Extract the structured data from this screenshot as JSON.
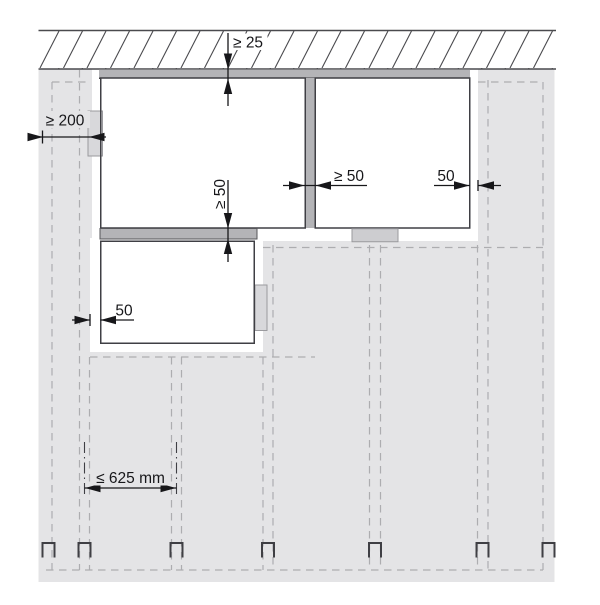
{
  "diagram": {
    "type": "technical-installation-clearance-drawing",
    "labels": {
      "ceiling_gap": "≥ 25",
      "left_edge_distance": "≥ 200",
      "between_boxes_vertical": "≥ 50",
      "between_boxes_horizontal": "≥ 50",
      "right_edge_gap": "50",
      "lower_box_edge_gap": "50",
      "stud_spacing": "≤ 625 mm"
    },
    "colors": {
      "panel": "#e4e4e6",
      "rail": "#b4b4b7",
      "tab": "#d8d8db",
      "tab_small": "#cdcdd0",
      "outline": "#3f3f44",
      "dashed_line": "#adadb0",
      "dimension": "#17171a"
    }
  }
}
